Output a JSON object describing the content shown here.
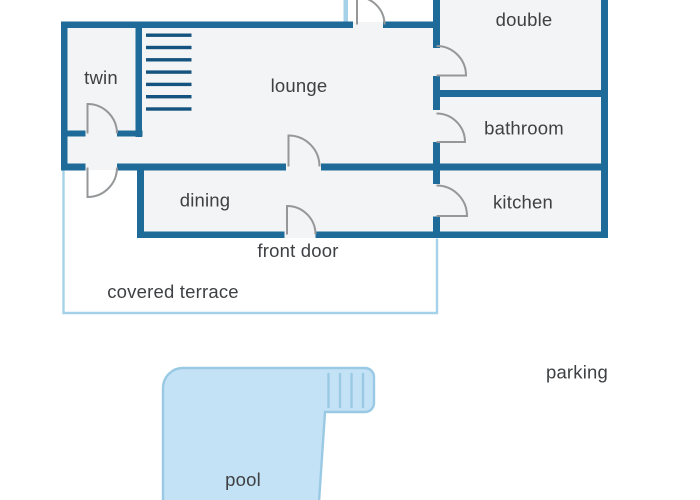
{
  "floor_plan": {
    "rooms": {
      "twin": "twin",
      "lounge": "lounge",
      "double": "double",
      "bathroom": "bathroom",
      "kitchen": "kitchen",
      "dining": "dining"
    },
    "annotations": {
      "front_door": "front door"
    },
    "outdoor": {
      "covered_terrace": "covered terrace",
      "pool": "pool",
      "parking": "parking"
    }
  },
  "colors": {
    "wall": "#1e6b99",
    "stair": "#14537f",
    "door": "#959799",
    "room_fill": "#f3f4f5",
    "terrace_line": "#a6d2e9",
    "window": "#a6d2e9",
    "pool_fill": "#c4e2f5",
    "pool_line": "#9ac9e4",
    "text": "#3e4043",
    "background": "#ffffff"
  }
}
